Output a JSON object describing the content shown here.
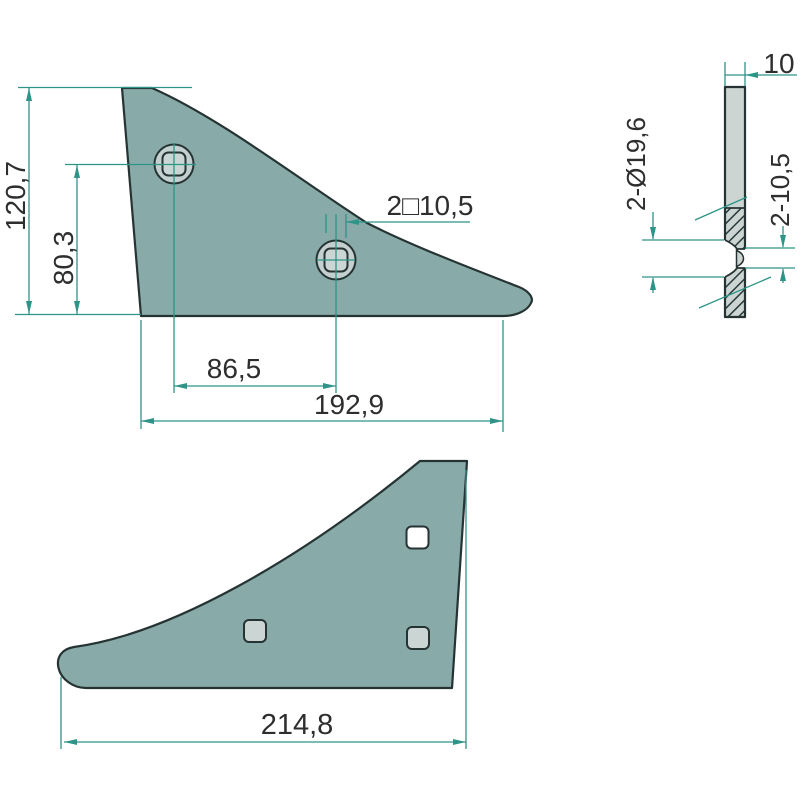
{
  "drawing": {
    "type": "technical-drawing",
    "part": "plough-share-wing",
    "colors": {
      "background": "#ffffff",
      "part_fill": "#88aba9",
      "hole_circle_fill": "#c3d0cf",
      "hole_square_fill": "#cbd6d4",
      "section_fill": "#cdd5d3",
      "white_hole_fill": "#ffffff",
      "outline": "#263333",
      "dimension": "#2e9488",
      "text": "#2e2e2e"
    },
    "views": {
      "side": {
        "dim_total_height": "120,7",
        "dim_hole_height": "80,3",
        "dim_hole_spacing": "86,5",
        "dim_total_length": "192,9",
        "label_square_holes": "2□10,5"
      },
      "section": {
        "dim_thickness": "10",
        "label_countersink": "2-Ø19,6",
        "label_square_hole": "2-10,5"
      },
      "back": {
        "dim_total_length": "214,8"
      }
    }
  }
}
